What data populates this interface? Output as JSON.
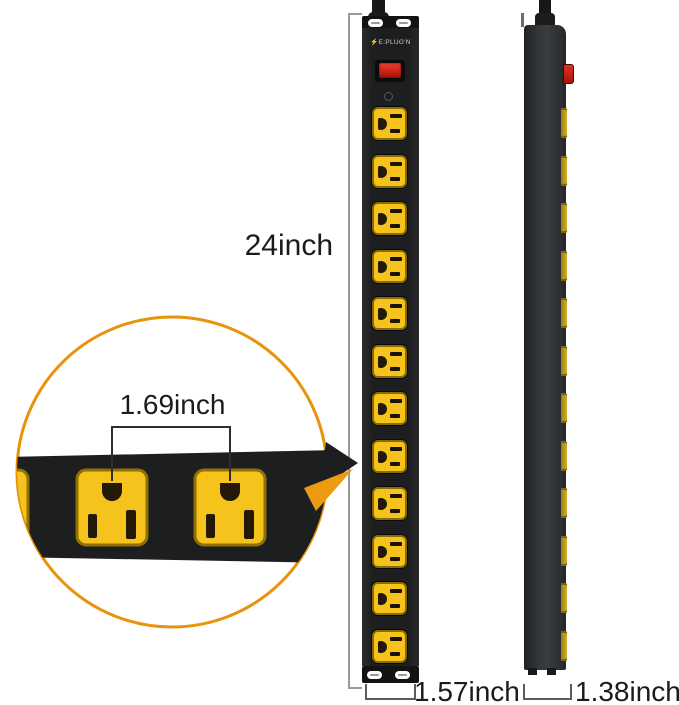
{
  "brand": {
    "logo_text": "E:PLUG'N"
  },
  "labels": {
    "strip_length": "24inch",
    "outlet_spacing": "1.69inch",
    "front_width": "1.57inch",
    "side_depth": "1.38inch"
  },
  "front_view": {
    "outlet_count": 12
  },
  "side_view": {
    "outlet_count": 12
  },
  "callout": {
    "visible_full_outlets": 2,
    "visible_partial_outlets": 1
  },
  "colors": {
    "accent_orange": "#E8930B",
    "outlet_yellow": "#F5C31C",
    "body_black": "#1D1E20",
    "switch_red": "#D92318"
  }
}
